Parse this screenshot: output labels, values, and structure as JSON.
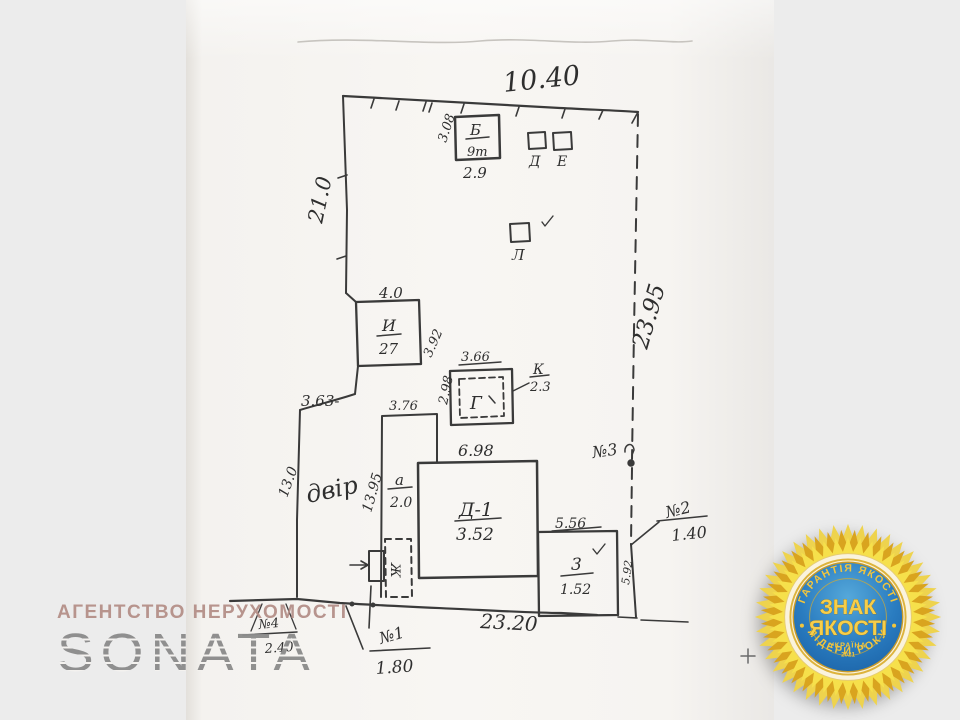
{
  "scan": {
    "labels": {
      "top_width": "10.40",
      "left_len": "21.0",
      "right_len": "23.95",
      "bottom_len": "23.20",
      "b": {
        "name": "Б",
        "area": "9т",
        "h": "3.08",
        "w": "2.9"
      },
      "d": "Д",
      "e": "Е",
      "l": "Л",
      "i": {
        "name": "И",
        "area": "27",
        "top": "4.0",
        "side": "3.92"
      },
      "g": {
        "name": "Г",
        "top": "3.66",
        "side": "2.98"
      },
      "k": {
        "name": "К",
        "val": "2.3"
      },
      "step": "3.63-",
      "col": "3.76",
      "yard": "двір",
      "yard_len": "13.95",
      "outer_left": "13.0",
      "a": {
        "name": "а",
        "val": "2.0"
      },
      "house": {
        "name": "Д-1",
        "val": "3.52",
        "top": "6.98"
      },
      "zh": "Ж",
      "z": {
        "name": "3",
        "val": "1.52",
        "top": "5.56",
        "side": "5.92"
      },
      "n1": {
        "name": "№1",
        "val": "1.80"
      },
      "n2": {
        "name": "№2",
        "val": "1.40"
      },
      "n3": {
        "name": "№3"
      },
      "n4": {
        "name": "№4",
        "val": "2.40"
      }
    }
  },
  "watermark": {
    "agency_line": "АГЕНТСТВО НЕРУХОМОСТІ",
    "agency_name": "SONATA",
    "line_color": "#b5918a",
    "name_color": "#8f8f8f"
  },
  "badge": {
    "top_arc": "ГАРАНТІЯ ЯКОСТІ",
    "bottom_arc": "ЛІДЕРИ РОКУ",
    "line1": "ЗНАК",
    "line2": "ЯКОСТІ",
    "country": "УКРАЇНА",
    "year": "2021",
    "colors": {
      "blue": "#2277bd",
      "gold_text": "#f2c53d",
      "petal": "#f6e04b"
    }
  }
}
